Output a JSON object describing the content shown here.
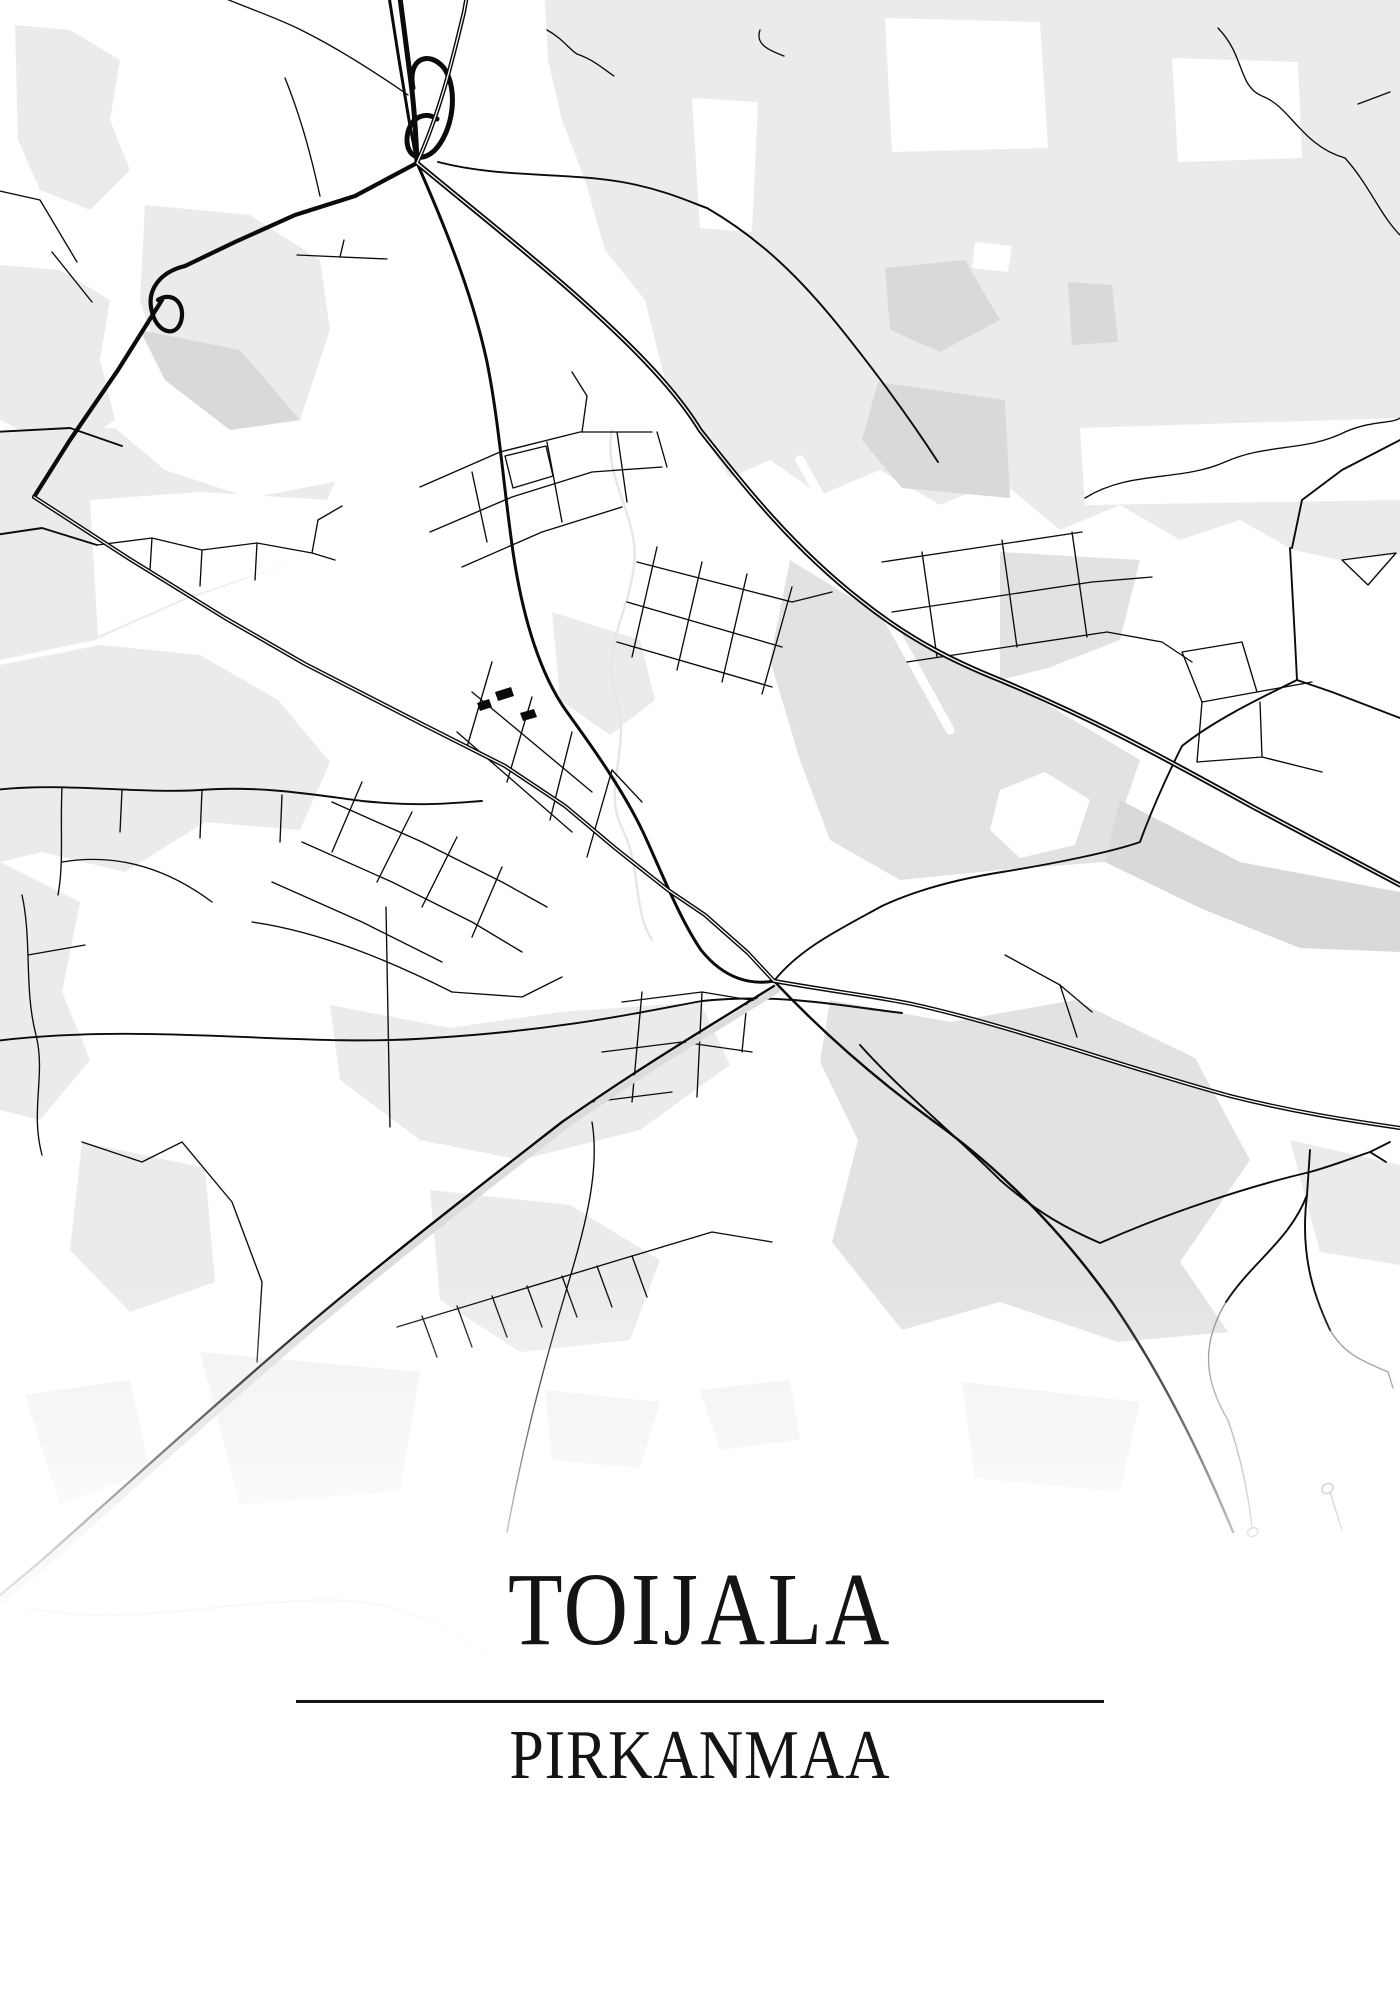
{
  "poster": {
    "title": "TOIJALA",
    "subtitle": "PIRKANMAA"
  },
  "theme": {
    "background": "#ffffff",
    "road_color": "#0b0b0b",
    "land_light": "#ebebed",
    "land_mid": "#e2e2e4",
    "land_dark": "#d9d9db",
    "stream_color": "#e6e6e8",
    "text_color": "#141414",
    "divider_color": "#141414"
  }
}
